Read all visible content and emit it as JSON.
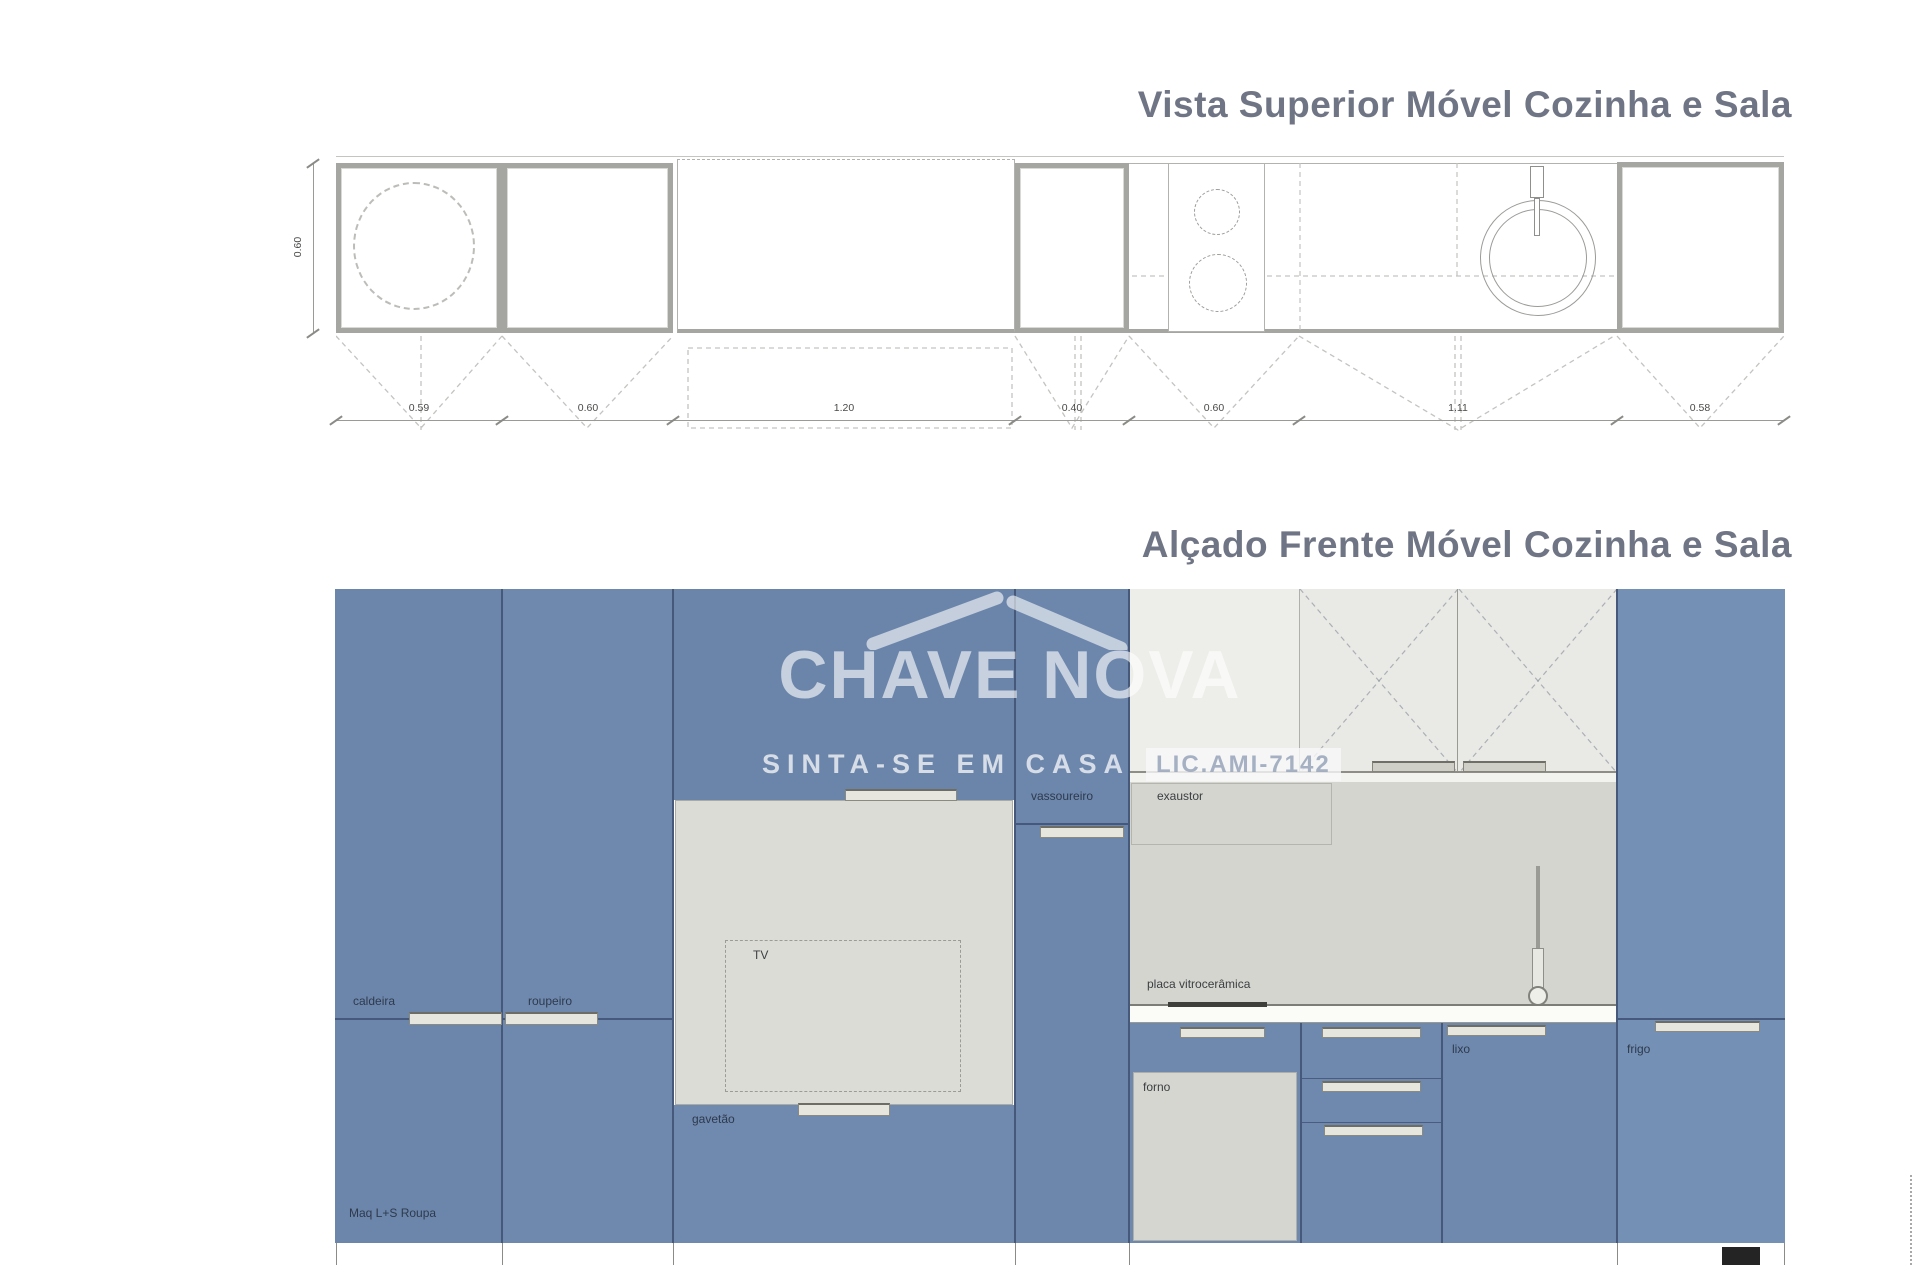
{
  "titles": {
    "plan": "Vista Superior Móvel Cozinha e Sala",
    "elevation": "Alçado Frente Móvel Cozinha e Sala"
  },
  "watermark": {
    "brand": "CHAVE NOVA",
    "tagline": "SINTA-SE EM CASA",
    "license": "LIC.AMI-7142"
  },
  "plan": {
    "depth": "0.60",
    "widths": [
      "0.59",
      "0.60",
      "1.20",
      "0.40",
      "0.60",
      "1.11",
      "0.58"
    ]
  },
  "elevation": {
    "labels": {
      "caldeira": "caldeira",
      "roupeiro": "roupeiro",
      "maq": "Maq L+S Roupa",
      "tv": "TV",
      "gavetao": "gavetão",
      "vassoureiro": "vassoureiro",
      "exaustor": "exaustor",
      "placa": "placa vitrocerâmica",
      "forno": "forno",
      "lixo": "lixo",
      "frigo": "frigo"
    }
  },
  "colors": {
    "cabinet_blue": "#6f89ae",
    "title_gray_blue": "#6f7584",
    "niche_gray": "#dcdcd6",
    "backsplash_gray": "#d5d5cf"
  }
}
